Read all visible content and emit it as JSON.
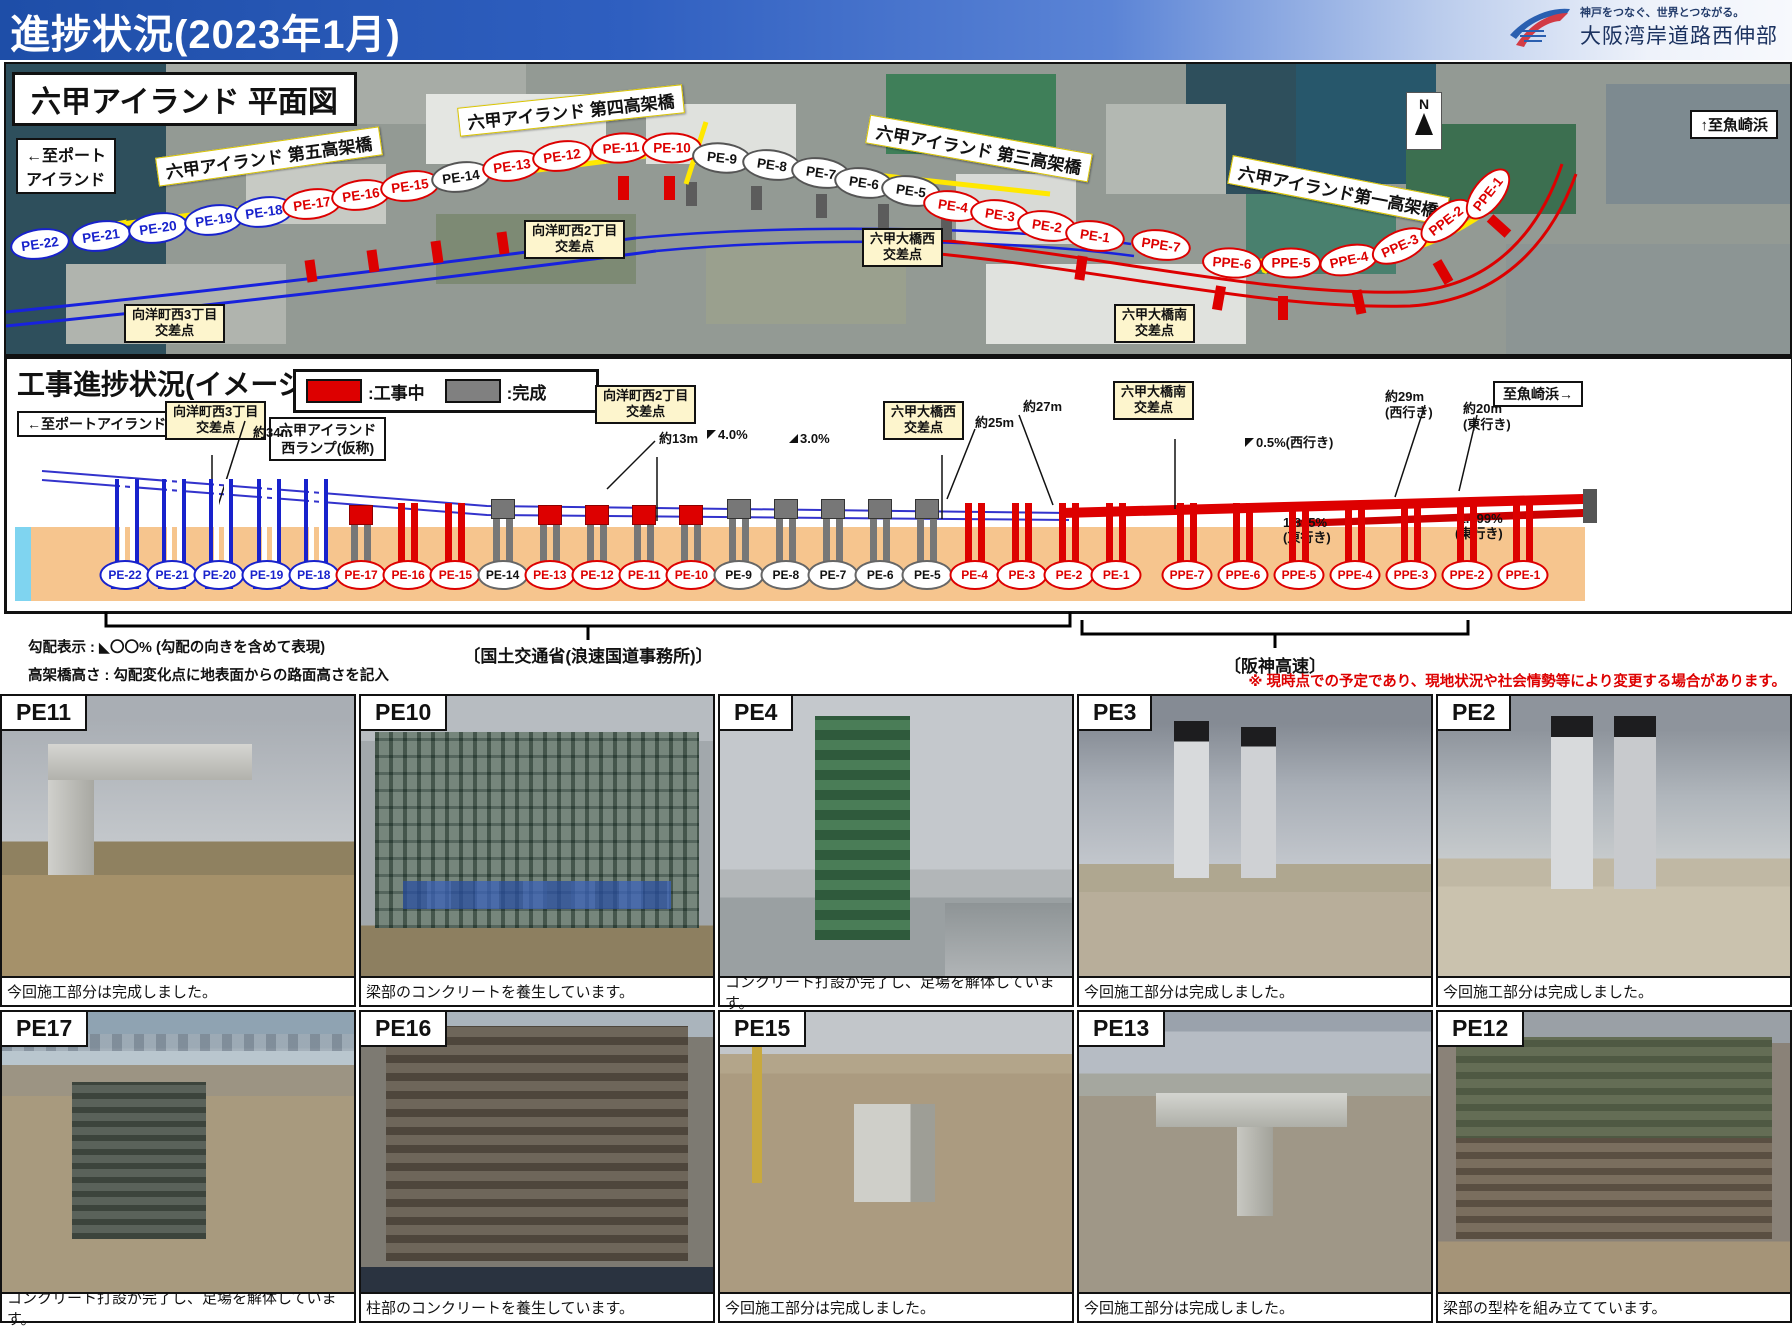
{
  "header": {
    "title": "進捗状況(2023年1月)",
    "logo_tagline": "神戸をつなぐ、世界とつながる。",
    "logo_org": "大阪湾岸道路西伸部"
  },
  "map": {
    "title": "六甲アイランド 平面図",
    "dir_left": "←至ポート\nアイランド",
    "dir_right": "↑至魚崎浜",
    "compass_n": "N",
    "viaducts": [
      "六甲アイランド 第五高架橋",
      "六甲アイランド 第四高架橋",
      "六甲アイランド 第三高架橋",
      "六甲アイランド第一高架橋"
    ]
  },
  "intersections": [
    "向洋町西3丁目\n交差点",
    "向洋町西2丁目\n交差点",
    "六甲大橋西\n交差点",
    "六甲大橋南\n交差点"
  ],
  "piers": [
    {
      "id": "PE-22",
      "status": "planned",
      "icon": "blue"
    },
    {
      "id": "PE-21",
      "status": "planned",
      "icon": "blue"
    },
    {
      "id": "PE-20",
      "status": "planned",
      "icon": "blue"
    },
    {
      "id": "PE-19",
      "status": "planned",
      "icon": "blue"
    },
    {
      "id": "PE-18",
      "status": "planned",
      "icon": "blue"
    },
    {
      "id": "PE-17",
      "status": "active",
      "icon": "gray-red"
    },
    {
      "id": "PE-16",
      "status": "active",
      "icon": "red"
    },
    {
      "id": "PE-15",
      "status": "active",
      "icon": "red"
    },
    {
      "id": "PE-14",
      "status": "done",
      "icon": "gray"
    },
    {
      "id": "PE-13",
      "status": "active",
      "icon": "gray-red"
    },
    {
      "id": "PE-12",
      "status": "active",
      "icon": "gray-red"
    },
    {
      "id": "PE-11",
      "status": "active",
      "icon": "gray-red"
    },
    {
      "id": "PE-10",
      "status": "active",
      "icon": "gray-red"
    },
    {
      "id": "PE-9",
      "status": "done",
      "icon": "gray"
    },
    {
      "id": "PE-8",
      "status": "done",
      "icon": "gray"
    },
    {
      "id": "PE-7",
      "status": "done",
      "icon": "gray"
    },
    {
      "id": "PE-6",
      "status": "done",
      "icon": "gray"
    },
    {
      "id": "PE-5",
      "status": "done",
      "icon": "gray"
    },
    {
      "id": "PE-4",
      "status": "active",
      "icon": "red"
    },
    {
      "id": "PE-3",
      "status": "active",
      "icon": "red"
    },
    {
      "id": "PE-2",
      "status": "active",
      "icon": "red"
    },
    {
      "id": "PE-1",
      "status": "active",
      "icon": "red"
    },
    {
      "id": "PPE-7",
      "status": "active",
      "icon": "red"
    },
    {
      "id": "PPE-6",
      "status": "active",
      "icon": "red"
    },
    {
      "id": "PPE-5",
      "status": "active",
      "icon": "red"
    },
    {
      "id": "PPE-4",
      "status": "active",
      "icon": "red"
    },
    {
      "id": "PPE-3",
      "status": "active",
      "icon": "red"
    },
    {
      "id": "PPE-2",
      "status": "active",
      "icon": "red"
    },
    {
      "id": "PPE-1",
      "status": "active",
      "icon": "red"
    }
  ],
  "progress": {
    "title": "工事進捗状況(イメージ図)",
    "legend": [
      {
        "label": ":工事中",
        "color": "#dd0000"
      },
      {
        "label": ":完成",
        "color": "#808080"
      }
    ],
    "dir_left": "←至ポートアイランド",
    "dir_right": "至魚崎浜→",
    "ramp_label": "六甲アイランド\n西ランプ(仮称)",
    "measurements": {
      "m34": "約34m",
      "m13": "約13m",
      "m25": "約25m",
      "m27": "約27m",
      "m29": "約29m\n(西行き)",
      "m20": "約20m\n(東行き)"
    },
    "grades": {
      "g40": "4.0%",
      "g30": "3.0%",
      "g05": "0.5%(西行き)",
      "g1895": "1.895%\n(東行き)",
      "g1099": "1.099%\n(東行き)"
    },
    "agency_left": "〔国土交通省(浪速国道事務所)〕",
    "agency_right": "〔阪神高速〕",
    "note_grade": "勾配表示 : ◣〇〇% (勾配の向きを含めて表現)",
    "note_height": "高架橋高さ : 勾配変化点に地表面からの路面高さを記入",
    "disclaimer": "※ 現時点での予定であり、現地状況や社会情勢等により変更する場合があります。"
  },
  "photos": [
    {
      "id": "PE11",
      "caption": "今回施工部分は完成しました。"
    },
    {
      "id": "PE10",
      "caption": "梁部のコンクリートを養生しています。"
    },
    {
      "id": "PE4",
      "caption": "コンクリート打設が完了し、足場を解体しています。"
    },
    {
      "id": "PE3",
      "caption": "今回施工部分は完成しました。"
    },
    {
      "id": "PE2",
      "caption": "今回施工部分は完成しました。"
    },
    {
      "id": "PE17",
      "caption": "コンクリート打設が完了し、足場を解体しています。"
    },
    {
      "id": "PE16",
      "caption": "柱部のコンクリートを養生しています。"
    },
    {
      "id": "PE15",
      "caption": "今回施工部分は完成しました。"
    },
    {
      "id": "PE13",
      "caption": "今回施工部分は完成しました。"
    },
    {
      "id": "PE12",
      "caption": "梁部の型枠を組み立てています。"
    }
  ]
}
